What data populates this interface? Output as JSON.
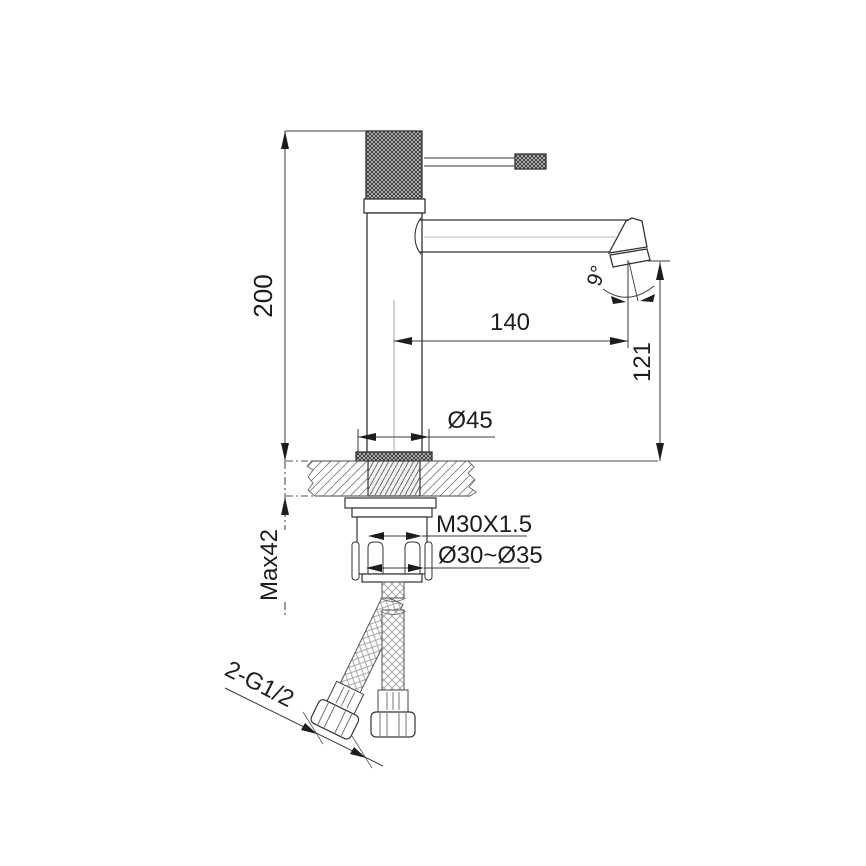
{
  "drawing": {
    "title": "basin-mixer-faucet-technical-drawing",
    "colors": {
      "outline": "#333333",
      "dimension_line": "#444444",
      "hatch": "#777777",
      "knurl_fill": "#c9c9c9",
      "background": "#ffffff"
    },
    "dimensions": {
      "overall_height": "200",
      "spout_reach": "140",
      "spout_outlet_height": "121",
      "spout_angle": "9°",
      "base_diameter": "Ø45",
      "mounting_thread": "M30X1.5",
      "hole_diameter_range": "Ø30~Ø35",
      "max_counter_thickness": "Max42",
      "hose_connection": "2-G1/2"
    }
  }
}
